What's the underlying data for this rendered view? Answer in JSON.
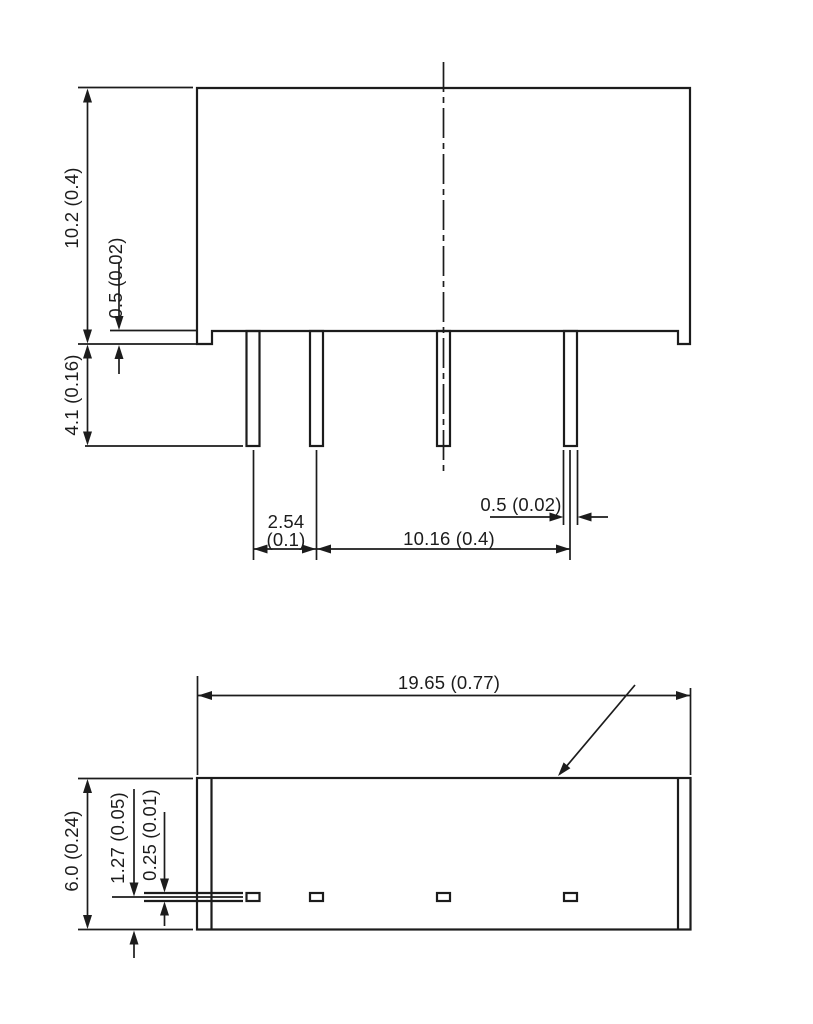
{
  "drawing": {
    "type": "mechanical-dimension-drawing",
    "description": "Two-view outline drawing of a 4-pin SIP package, dimensions in mm (inch)",
    "units": "mm (inch)",
    "colors": {
      "line": "#1c1c1c",
      "background": "#ffffff"
    },
    "front_view": {
      "name": "front view with pins",
      "dim_body_height": "10.2 (0.4)",
      "dim_standoff": "0.5 (0.02)",
      "dim_pin_length": "4.1 (0.16)",
      "dim_pin_pitch_mm": "2.54",
      "dim_pin_pitch_inch": "(0.1)",
      "dim_pin_span": "10.16 (0.4)",
      "dim_pin_width": "0.5 (0.02)",
      "pin_count": 4
    },
    "bottom_view": {
      "name": "bottom view",
      "dim_body_length": "19.65 (0.77)",
      "dim_body_depth": "6.0 (0.24)",
      "dim_pin_row_offset": "1.27 (0.05)",
      "dim_pin_thickness": "0.25 (0.01)"
    }
  }
}
